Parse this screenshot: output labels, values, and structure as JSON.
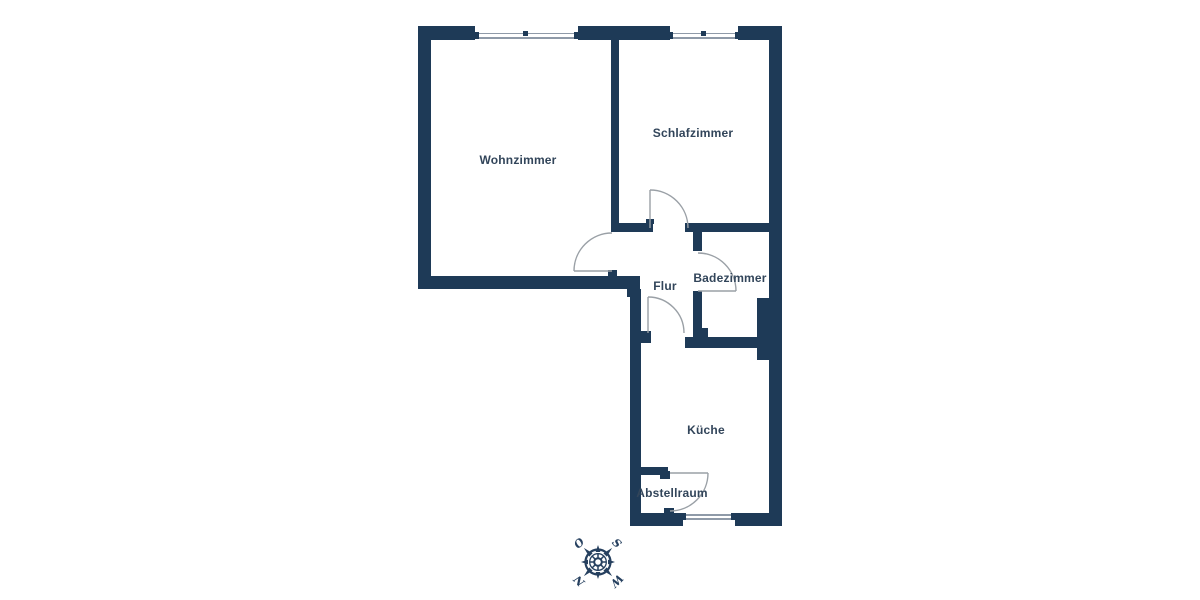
{
  "floorplan": {
    "rooms": [
      {
        "id": "wohnzimmer",
        "label": "Wohnzimmer"
      },
      {
        "id": "schlafzimmer",
        "label": "Schlafzimmer"
      },
      {
        "id": "flur",
        "label": "Flur"
      },
      {
        "id": "badezimmer",
        "label": "Badezimmer"
      },
      {
        "id": "kueche",
        "label": "Küche"
      },
      {
        "id": "abstellraum",
        "label": "Abstellraum"
      }
    ],
    "colors": {
      "wall": "#1e3a57",
      "room_label": "#32455a",
      "door_swing": "#9aa0a6",
      "window_line": "#8f9aa8",
      "compass": "#26405f"
    }
  },
  "compass": {
    "letters": [
      {
        "text": "O",
        "position": "top-left"
      },
      {
        "text": "S",
        "position": "top-right"
      },
      {
        "text": "N",
        "position": "bottom-left"
      },
      {
        "text": "W",
        "position": "bottom-right"
      }
    ]
  }
}
